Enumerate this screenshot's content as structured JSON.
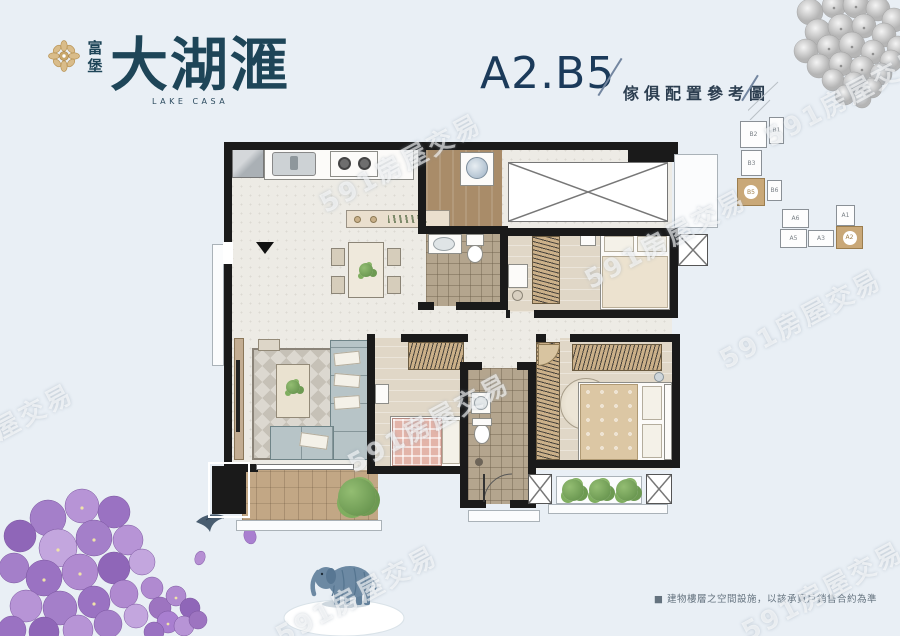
{
  "logo": {
    "prefix": "富堡",
    "name": "大湖滙",
    "subtitle": "LAKE CASA"
  },
  "header": {
    "unit_code": "A2.B5",
    "caption": "傢俱配置參考圖"
  },
  "keyplan": {
    "building_b": {
      "units": [
        "B2",
        "B1",
        "B3",
        "B5",
        "B6"
      ],
      "highlighted": "B5"
    },
    "building_a": {
      "units": [
        "A6",
        "A1",
        "A5",
        "A3",
        "A2"
      ],
      "highlighted": "A2"
    },
    "highlight_color": "#c9a878"
  },
  "watermark": {
    "text": "591房屋交易",
    "positions": [
      {
        "x": 400,
        "y": 162
      },
      {
        "x": 845,
        "y": 96
      },
      {
        "x": 665,
        "y": 238
      },
      {
        "x": 800,
        "y": 318
      },
      {
        "x": 428,
        "y": 422
      },
      {
        "x": -8,
        "y": 432
      },
      {
        "x": 356,
        "y": 594
      },
      {
        "x": 822,
        "y": 590
      }
    ]
  },
  "disclaimer": {
    "text": "■ 建物樓層之空間設施，以該承買戶銷售合約為準"
  },
  "colors": {
    "background": "#e9eff5",
    "brand_navy": "#1e4558",
    "title_navy": "#1b3a5a",
    "logo_gold": "#c8a76b",
    "keyplan_highlight": "#c9a878",
    "wall_black": "#1a1a1a",
    "flower_purple": "#a47fc9"
  }
}
